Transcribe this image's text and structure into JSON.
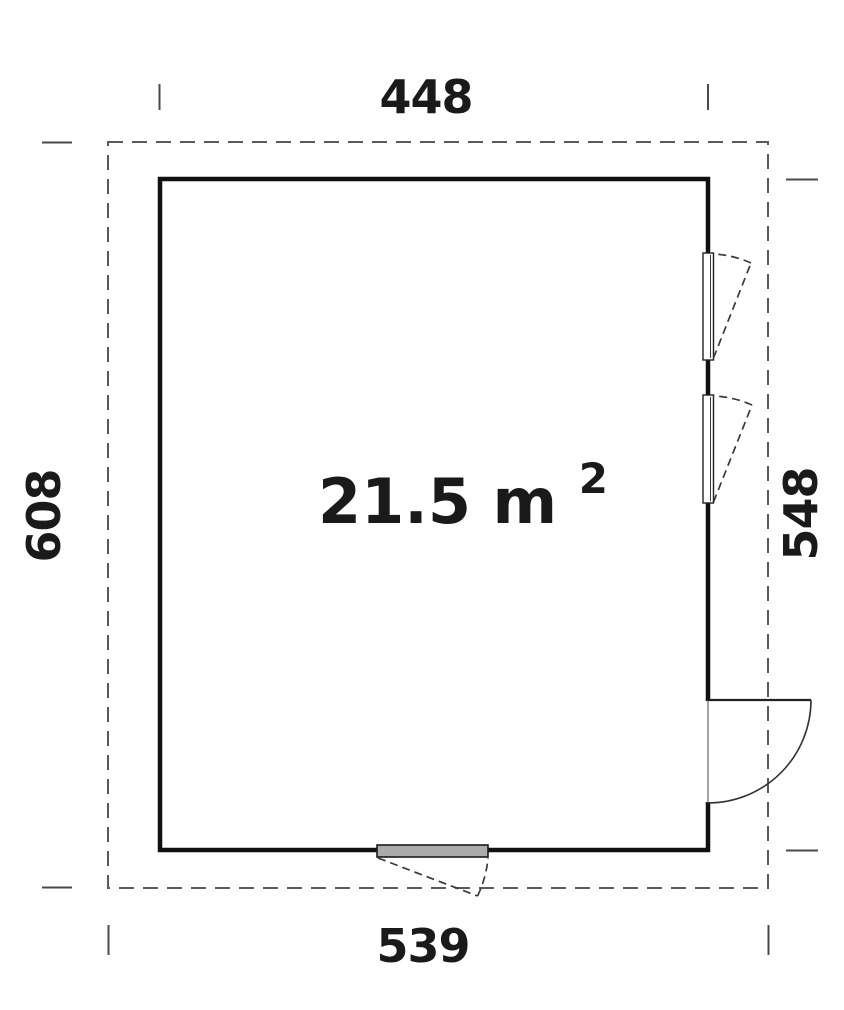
{
  "plan": {
    "area_value": "21.5 m",
    "area_exponent": "2",
    "dimensions": {
      "top": "448",
      "bottom": "539",
      "left": "608",
      "right": "548"
    },
    "colors": {
      "wall": "#101010",
      "dashed_outline": "#5a5a5a",
      "tick": "#4a4a4a",
      "text": "#1a1a1a",
      "swing": "#3a3a3a",
      "door_panel_fill": "#ababab"
    }
  }
}
